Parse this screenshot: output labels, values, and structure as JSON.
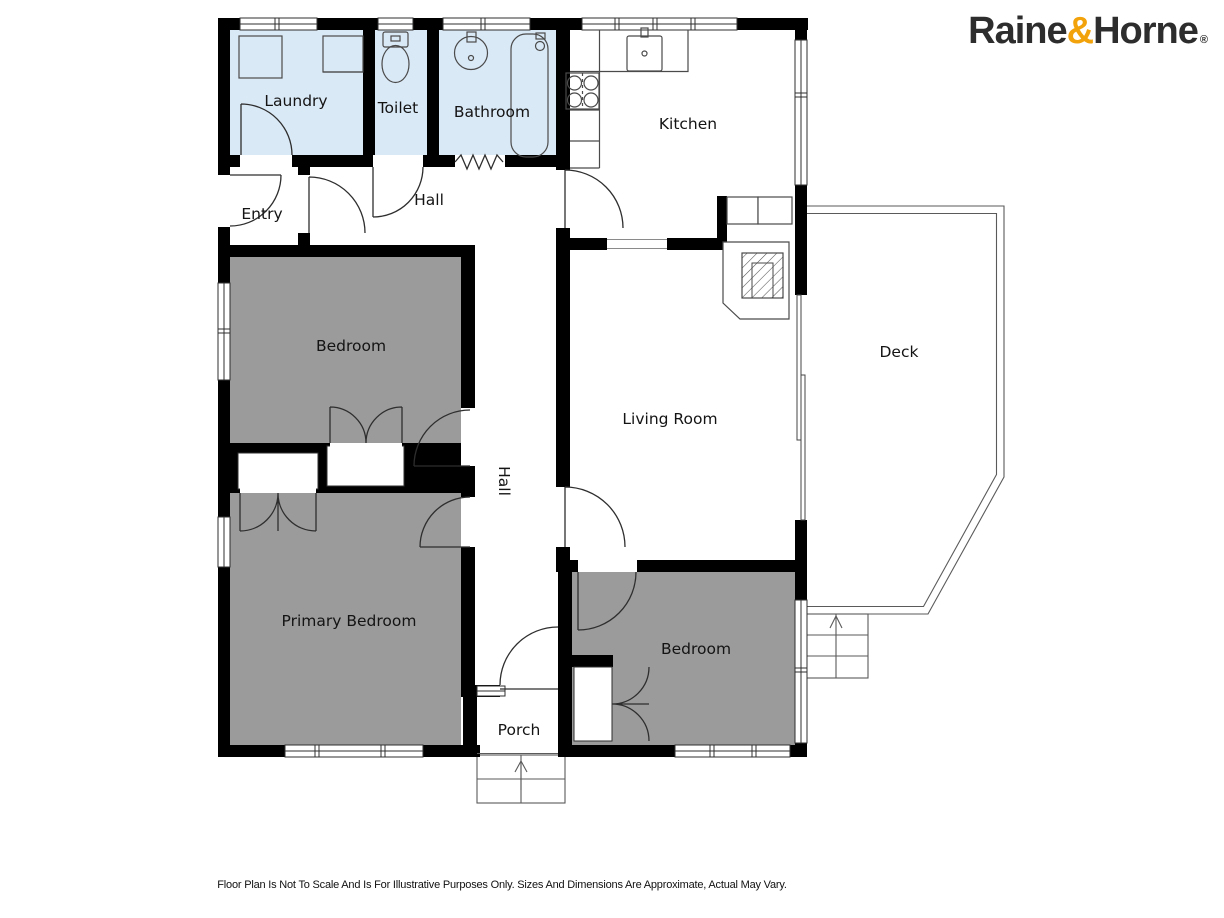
{
  "logo": {
    "raine": "Raine",
    "ampersand": "&",
    "horne": "Horne",
    "registered": "®"
  },
  "brand_colors": {
    "logo_text": "#2D2D2D",
    "logo_ampersand": "#F2A30B"
  },
  "plan_colors": {
    "wall": "#000000",
    "wet_room_fill": "#DAE9F6",
    "bedroom_fill": "#9B9B9B",
    "deck_line": "#5A5A5A"
  },
  "rooms": {
    "laundry": "Laundry",
    "toilet": "Toilet",
    "bathroom": "Bathroom",
    "kitchen": "Kitchen",
    "entry": "Entry",
    "hall_upper": "Hall",
    "bedroom_front": "Bedroom",
    "living_room": "Living Room",
    "deck": "Deck",
    "hall_lower": "Hall",
    "primary_bedroom": "Primary Bedroom",
    "bedroom_rear": "Bedroom",
    "porch": "Porch"
  },
  "footer": {
    "disclaimer": "Floor Plan Is Not To Scale And Is For Illustrative Purposes Only. Sizes And Dimensions Are Approximate, Actual May Vary."
  }
}
